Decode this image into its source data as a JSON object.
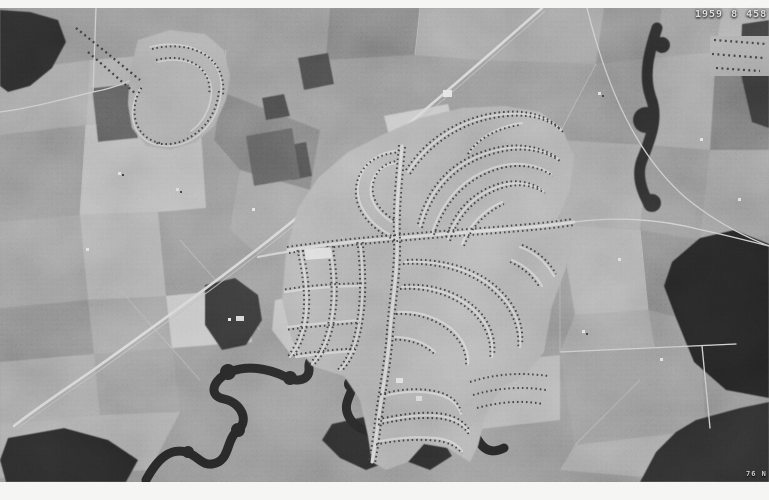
{
  "photo_stamp": {
    "year": "1959",
    "code": "8",
    "frame": "458"
  },
  "corner_mark": "76 N",
  "palette": {
    "paper": "#f5f5f3",
    "photo_base": "#8f8f8f",
    "forest_dark": "#262626",
    "road_light": "#cccccc",
    "house_dark": "#3a3a3a"
  }
}
